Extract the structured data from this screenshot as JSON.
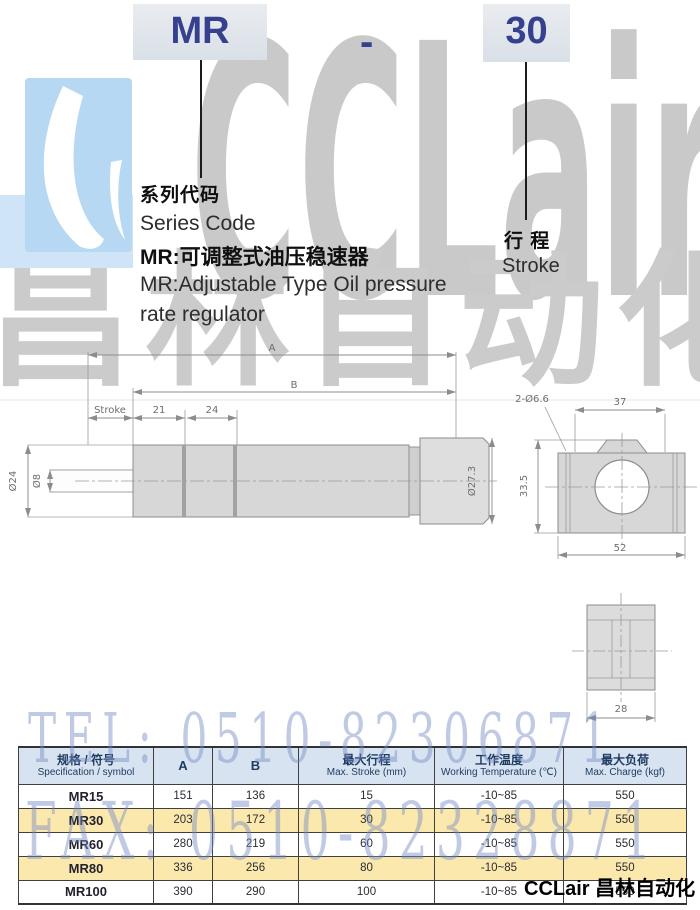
{
  "model_code": {
    "series": "MR",
    "separator": "-",
    "stroke_code": "30"
  },
  "series_note": {
    "label_cn": "系列代码",
    "label_en": "Series Code",
    "desc_cn": "MR:可调整式油压稳速器",
    "desc_en_line1": "MR:Adjustable Type Oil pressure",
    "desc_en_line2": "rate regulator"
  },
  "stroke_note": {
    "label_cn": "行 程",
    "label_en": "Stroke"
  },
  "watermark": {
    "brand_latin": "CCLair",
    "brand_cn": "昌林自动化",
    "tel_line": "TEL: 0510-82306871",
    "fax_line": "FAX: 0510-82328871"
  },
  "footer_brand": "CCLair 昌林自动化",
  "drawing": {
    "main_view": {
      "dim_A": "A",
      "dim_B": "B",
      "dim_stroke": "Stroke",
      "dim_21": "21",
      "dim_24": "24",
      "dia_rod_outer": "Ø24",
      "dia_rod": "Ø8",
      "dia_body_end": "Ø27.3"
    },
    "mount_view": {
      "dim_holes": "2-Ø6.6",
      "dim_width_top": "37",
      "dim_height": "33.5",
      "dim_width_bottom": "52"
    },
    "side_view": {
      "dim_depth": "28"
    }
  },
  "table": {
    "headers": {
      "spec_cn": "规格 / 符号",
      "spec_en": "Specification / symbol",
      "col_a": "A",
      "col_b": "B",
      "stroke_cn": "最大行程",
      "stroke_en": "Max. Stroke (mm)",
      "temp_cn": "工作温度",
      "temp_en": "Working Temperature (℃)",
      "charge_cn": "最大负荷",
      "charge_en": "Max. Charge (kgf)"
    },
    "rows": [
      {
        "model": "MR15",
        "a": "151",
        "b": "136",
        "max_stroke": "15",
        "temp": "-10~85",
        "charge": "550"
      },
      {
        "model": "MR30",
        "a": "203",
        "b": "172",
        "max_stroke": "30",
        "temp": "-10~85",
        "charge": "550"
      },
      {
        "model": "MR60",
        "a": "280",
        "b": "219",
        "max_stroke": "60",
        "temp": "-10~85",
        "charge": "550"
      },
      {
        "model": "MR80",
        "a": "336",
        "b": "256",
        "max_stroke": "80",
        "temp": "-10~85",
        "charge": "550"
      },
      {
        "model": "MR100",
        "a": "390",
        "b": "290",
        "max_stroke": "100",
        "temp": "-10~85",
        "charge": "550"
      }
    ]
  },
  "colors": {
    "accent_blue_text": "#35408e",
    "code_box_bg": "#dfe4ea",
    "logo_blue": "#b7d8f3",
    "table_header_bg": "#d8e3f1",
    "row_alt_bg": "#fbe8ad",
    "watermark_blue": "#748ac4",
    "watermark_gray": "#c9c9c9"
  }
}
